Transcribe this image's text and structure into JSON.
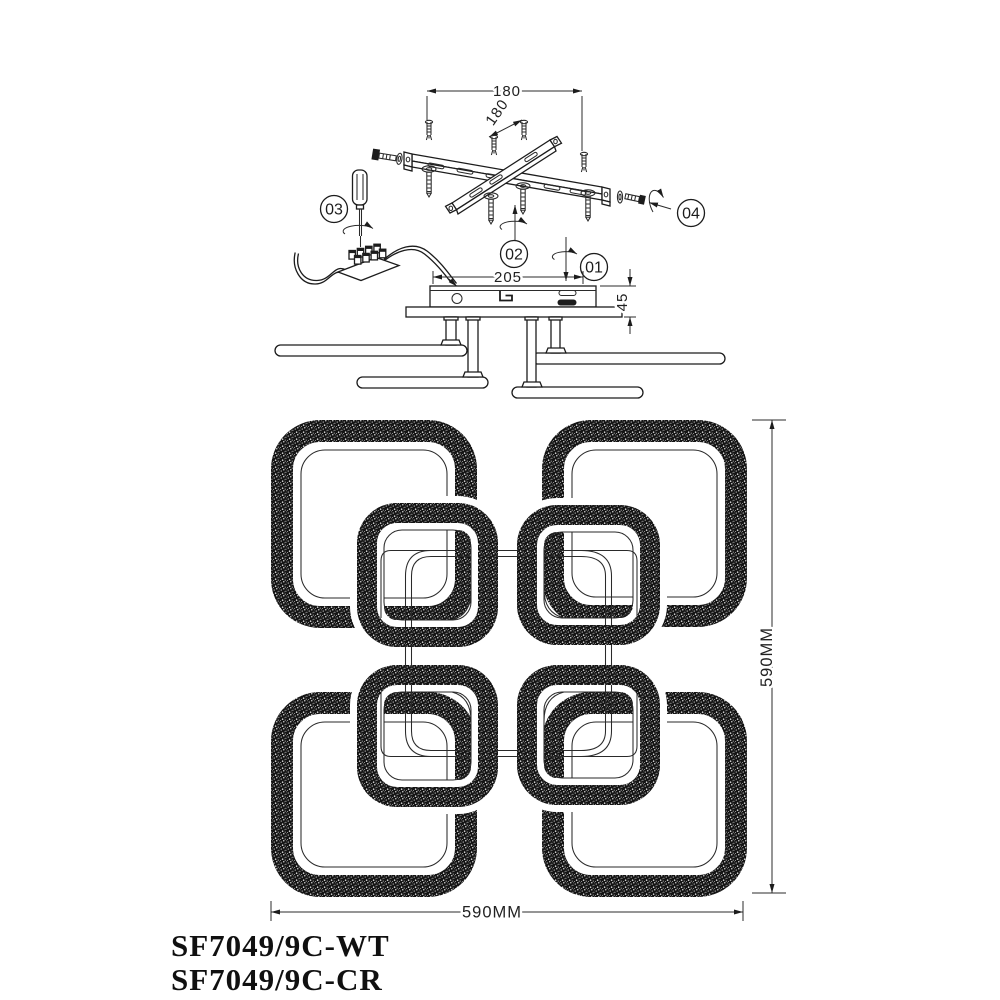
{
  "drawing": {
    "callouts": {
      "c1": "01",
      "c2": "02",
      "c3": "03",
      "c4": "04"
    },
    "dimensions": {
      "mount_spacing_h": "180",
      "mount_spacing_diag": "180",
      "canopy_length": "205",
      "canopy_height": "45",
      "fixture_width": "590MM",
      "fixture_height": "590MM"
    },
    "product_codes": {
      "white": "SF7049/9C-WT",
      "chrome": "SF7049/9C-CR"
    },
    "colors": {
      "line": "#1c1c1c",
      "band_fill": "#141414",
      "background": "#ffffff"
    }
  }
}
